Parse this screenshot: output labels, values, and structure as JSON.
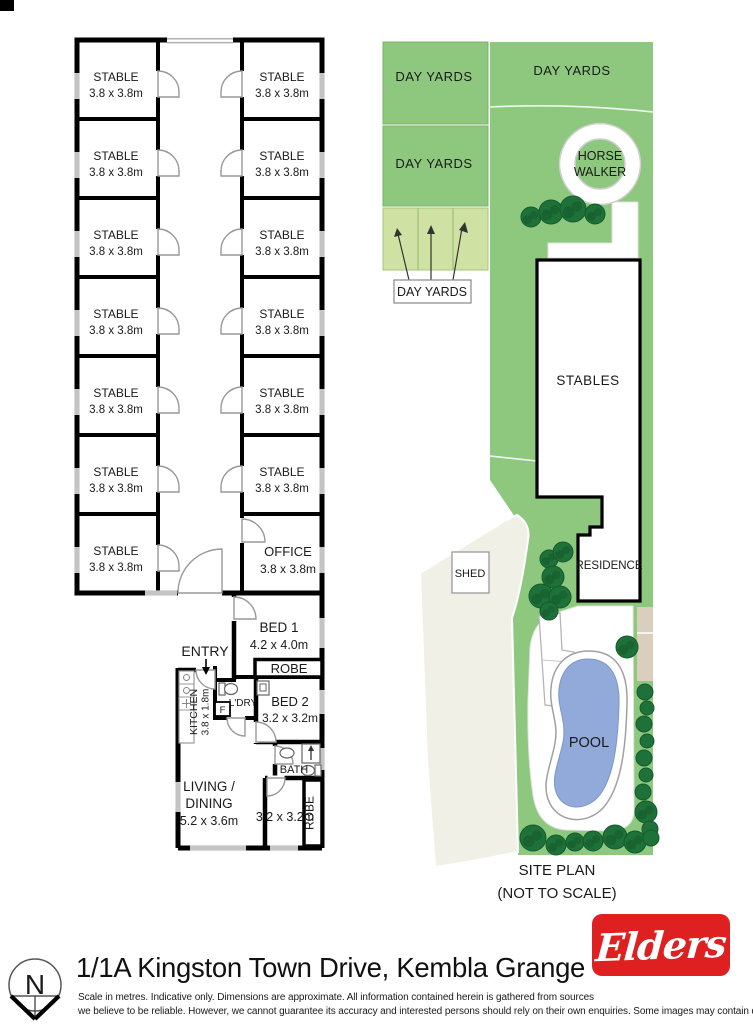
{
  "floor_plan": {
    "stable_label": "STABLE",
    "stable_dims": "3.8 x 3.8m",
    "left_column_count": 7,
    "right_column_count": 6,
    "office": {
      "label": "OFFICE",
      "dims": "3.8 x 3.8m"
    },
    "residence": {
      "entry": "ENTRY",
      "bed1": {
        "label": "BED 1",
        "dims": "4.2 x 4.0m"
      },
      "robe1": "ROBE",
      "kitchen": {
        "label": "KITCHEN",
        "dims": "3.8 x 1.8m"
      },
      "laundry": "L'DRY",
      "fridge": "F",
      "bed2": {
        "label": "BED 2",
        "dims": "3.2 x 3.2m"
      },
      "bath": "BATH",
      "living": {
        "line1": "LIVING /",
        "line2": "DINING",
        "dims": "5.2 x 3.6m"
      },
      "room3_dims": "3.2 x 3.2m",
      "robe2": "ROBE"
    }
  },
  "site_plan": {
    "day_yards": "DAY YARDS",
    "horse_walker": {
      "line1": "HORSE",
      "line2": "WALKER"
    },
    "stables": "STABLES",
    "shed": "SHED",
    "residence": "RESIDENCE",
    "pool": "POOL",
    "caption": {
      "line1": "SITE PLAN",
      "line2": "(NOT TO SCALE)"
    }
  },
  "footer": {
    "north": "N",
    "address": "1/1A Kingston Town Drive, Kembla Grange",
    "disclaimer_line1": "Scale in metres. Indicative only. Dimensions are approximate. All information contained herein is gathered from sources",
    "disclaimer_line2": "we believe to be reliable. However, we cannot guarantee its accuracy and interested persons should rely on their own enquiries. Some images may contain digital furniture.",
    "brand": "Elders"
  },
  "colors": {
    "green": "#8dc87e",
    "light_green": "#cfe2a3",
    "tree_green": "#1e7239",
    "tree_edge": "#155a2c",
    "pool_blue": "#91aad9",
    "cream": "#f1f0e7",
    "tan": "#d9cfbc",
    "brand_red": "#de2021",
    "window_gray": "#c4c4c4"
  }
}
